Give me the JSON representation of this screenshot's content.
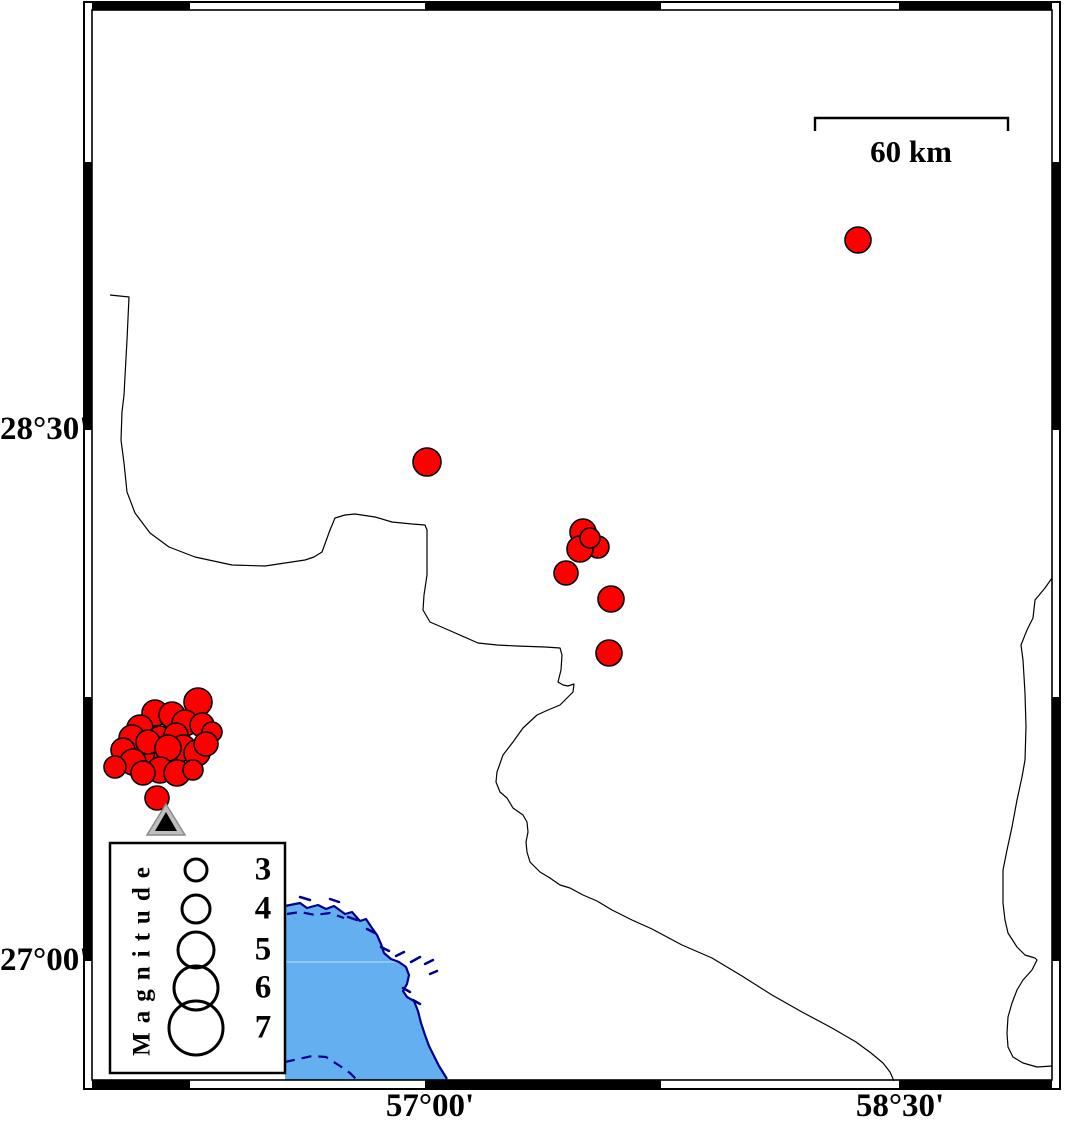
{
  "figure": {
    "width": 1066,
    "height": 1126,
    "background": "#ffffff"
  },
  "map": {
    "axis": {
      "left_labels": [
        {
          "text": "28°30'",
          "y": 430
        },
        {
          "text": "27°00'",
          "y": 961
        }
      ],
      "bottom_labels": [
        {
          "text": "57°00'",
          "x": 430
        },
        {
          "text": "58°30'",
          "x": 900
        }
      ]
    },
    "frame": {
      "outer": {
        "x": 84,
        "y": 2,
        "w": 976,
        "h": 1087
      },
      "inner": {
        "x": 92,
        "y": 10,
        "w": 960,
        "h": 1070
      },
      "band": 8,
      "top_black_segments": [
        [
          92,
          190
        ],
        [
          425,
          661
        ],
        [
          899,
          1052
        ]
      ],
      "bottom_black_segments": [
        [
          92,
          190
        ],
        [
          425,
          661
        ],
        [
          899,
          1052
        ]
      ],
      "left_black_segments": [
        [
          162,
          430
        ],
        [
          697,
          961
        ]
      ],
      "right_black_segments": [
        [
          162,
          430
        ],
        [
          697,
          961
        ]
      ]
    },
    "scalebar": {
      "label": "60 km",
      "x1": 815,
      "x2": 1008,
      "y": 118,
      "tick_drop": 13,
      "stroke": "#000000"
    },
    "legend": {
      "title": "Magnitude",
      "box": {
        "x": 110,
        "y": 843,
        "w": 175,
        "h": 230,
        "fill": "#ffffff",
        "stroke": "#000000"
      },
      "circle_cx": 196,
      "entries": [
        {
          "label": "3",
          "cy": 870,
          "r": 11
        },
        {
          "label": "4",
          "cy": 909,
          "r": 14
        },
        {
          "label": "5",
          "cy": 950,
          "r": 18
        },
        {
          "label": "6",
          "cy": 988,
          "r": 22
        },
        {
          "label": "7",
          "cy": 1028,
          "r": 27
        }
      ]
    },
    "sea": {
      "fill": "#64AFF0",
      "coast_color": "#00008B",
      "polygon": "285,906 300,903 307,908 318,905 326,909 334,906 345,914 352,912 360,921 366,919 372,928 377,935 381,944 384,953 391,959 399,962 406,967 409,975 407,984 403,991 407,997 414,1001 418,1011 421,1023 425,1035 429,1046 434,1056 439,1066 444,1074 447,1080 285,1080",
      "coastline": "285,906 300,903 307,908 318,905 326,909 334,906 345,914 352,912 360,921 366,919 372,928 377,935 381,944 384,953 391,959 399,962 406,967 409,975 407,984 403,991 407,997 414,1001 418,1011 421,1023 425,1035 429,1046 434,1056 439,1066 444,1074 447,1079",
      "islets": [
        [
          348,
          917,
          357,
          920
        ],
        [
          367,
          929,
          375,
          933
        ],
        [
          381,
          947,
          389,
          951
        ],
        [
          396,
          956,
          404,
          952
        ],
        [
          411,
          962,
          420,
          957
        ],
        [
          425,
          964,
          433,
          960
        ],
        [
          403,
          988,
          410,
          992
        ],
        [
          413,
          1000,
          420,
          1004
        ],
        [
          430,
          974,
          437,
          971
        ],
        [
          300,
          897,
          310,
          900
        ],
        [
          330,
          899,
          339,
          902
        ]
      ],
      "dashed_contours": [
        "287,914 300,912 315,915 330,913 344,918",
        "285,1062 312,1056 326,1057 340,1066 350,1073 356,1079"
      ],
      "graticule_line": {
        "x1": 286,
        "y1": 962,
        "x2": 399,
        "y2": 962,
        "color": "#A9D6F7"
      }
    },
    "borders": {
      "color": "#000000",
      "lines": [
        "110,295 129,297 127,340 124,395 122,412 121,440 124,463 127,492 135,513 150,533 169,547 195,557 232,565 265,566 285,563 305,560 314,557 322,552 330,530 335,518 345,515 355,514 375,517 392,522 412,524 425,525 427,530 427,555 427,575 424,595 423,610 430,622 453,632 478,643 497,645 517,646 545,647 560,648 562,655 561,670 558,682 563,685 568,686 574,684 573,692 567,698 560,705 548,710 537,715 523,728 513,742 503,755 497,772 496,782 500,792 507,798 513,808 523,815 527,822 528,832 526,842 527,852 530,862 540,872 550,878 560,885 570,888 583,895 597,901 612,910 632,920 652,929 682,945 712,958 742,976 772,995 802,1012 832,1028 856,1042 871,1053 883,1063 890,1072 894,1081",
        "1052,578 1045,588 1035,600 1033,618 1027,630 1021,645 1023,660 1025,693 1026,727 1025,760 1022,777 1017,800 1012,827 1007,850 1003,870 1003,890 1003,903 1005,920 1008,933 1017,947 1025,955 1035,958 1037,960 1032,970 1023,980 1017,990 1012,1003 1008,1017 1007,1033 1008,1047 1013,1057 1023,1063 1037,1067 1052,1066"
      ]
    },
    "earthquakes": {
      "fill": "#FF0000",
      "outline": "#000000",
      "events": [
        {
          "x": 198,
          "y": 702,
          "r": 14
        },
        {
          "x": 155,
          "y": 713,
          "r": 13
        },
        {
          "x": 172,
          "y": 715,
          "r": 13
        },
        {
          "x": 185,
          "y": 723,
          "r": 13
        },
        {
          "x": 202,
          "y": 725,
          "r": 12
        },
        {
          "x": 212,
          "y": 732,
          "r": 10
        },
        {
          "x": 140,
          "y": 728,
          "r": 13
        },
        {
          "x": 132,
          "y": 738,
          "r": 13
        },
        {
          "x": 160,
          "y": 738,
          "r": 12
        },
        {
          "x": 176,
          "y": 735,
          "r": 12
        },
        {
          "x": 123,
          "y": 750,
          "r": 12
        },
        {
          "x": 150,
          "y": 755,
          "r": 13
        },
        {
          "x": 167,
          "y": 757,
          "r": 13
        },
        {
          "x": 183,
          "y": 748,
          "r": 13
        },
        {
          "x": 197,
          "y": 753,
          "r": 13
        },
        {
          "x": 206,
          "y": 744,
          "r": 12
        },
        {
          "x": 148,
          "y": 742,
          "r": 12
        },
        {
          "x": 168,
          "y": 748,
          "r": 13
        },
        {
          "x": 133,
          "y": 762,
          "r": 13
        },
        {
          "x": 160,
          "y": 770,
          "r": 13
        },
        {
          "x": 177,
          "y": 773,
          "r": 13
        },
        {
          "x": 115,
          "y": 767,
          "r": 11
        },
        {
          "x": 143,
          "y": 773,
          "r": 12
        },
        {
          "x": 193,
          "y": 770,
          "r": 10
        },
        {
          "x": 157,
          "y": 798,
          "r": 12
        },
        {
          "x": 583,
          "y": 532,
          "r": 13
        },
        {
          "x": 598,
          "y": 547,
          "r": 11
        },
        {
          "x": 580,
          "y": 549,
          "r": 13
        },
        {
          "x": 590,
          "y": 538,
          "r": 10
        },
        {
          "x": 566,
          "y": 573,
          "r": 12
        },
        {
          "x": 611,
          "y": 599,
          "r": 13
        },
        {
          "x": 609,
          "y": 653,
          "r": 13
        },
        {
          "x": 427,
          "y": 462,
          "r": 14
        },
        {
          "x": 858,
          "y": 240,
          "r": 13
        }
      ]
    },
    "station": {
      "outer_triangle": "166,804 147,835 185,835",
      "inner_triangle": "166,812 155,831 177,831",
      "outer_fill": "#BFBFBF",
      "outer_stroke": "#8C8C8C",
      "inner_fill": "#000000"
    }
  }
}
